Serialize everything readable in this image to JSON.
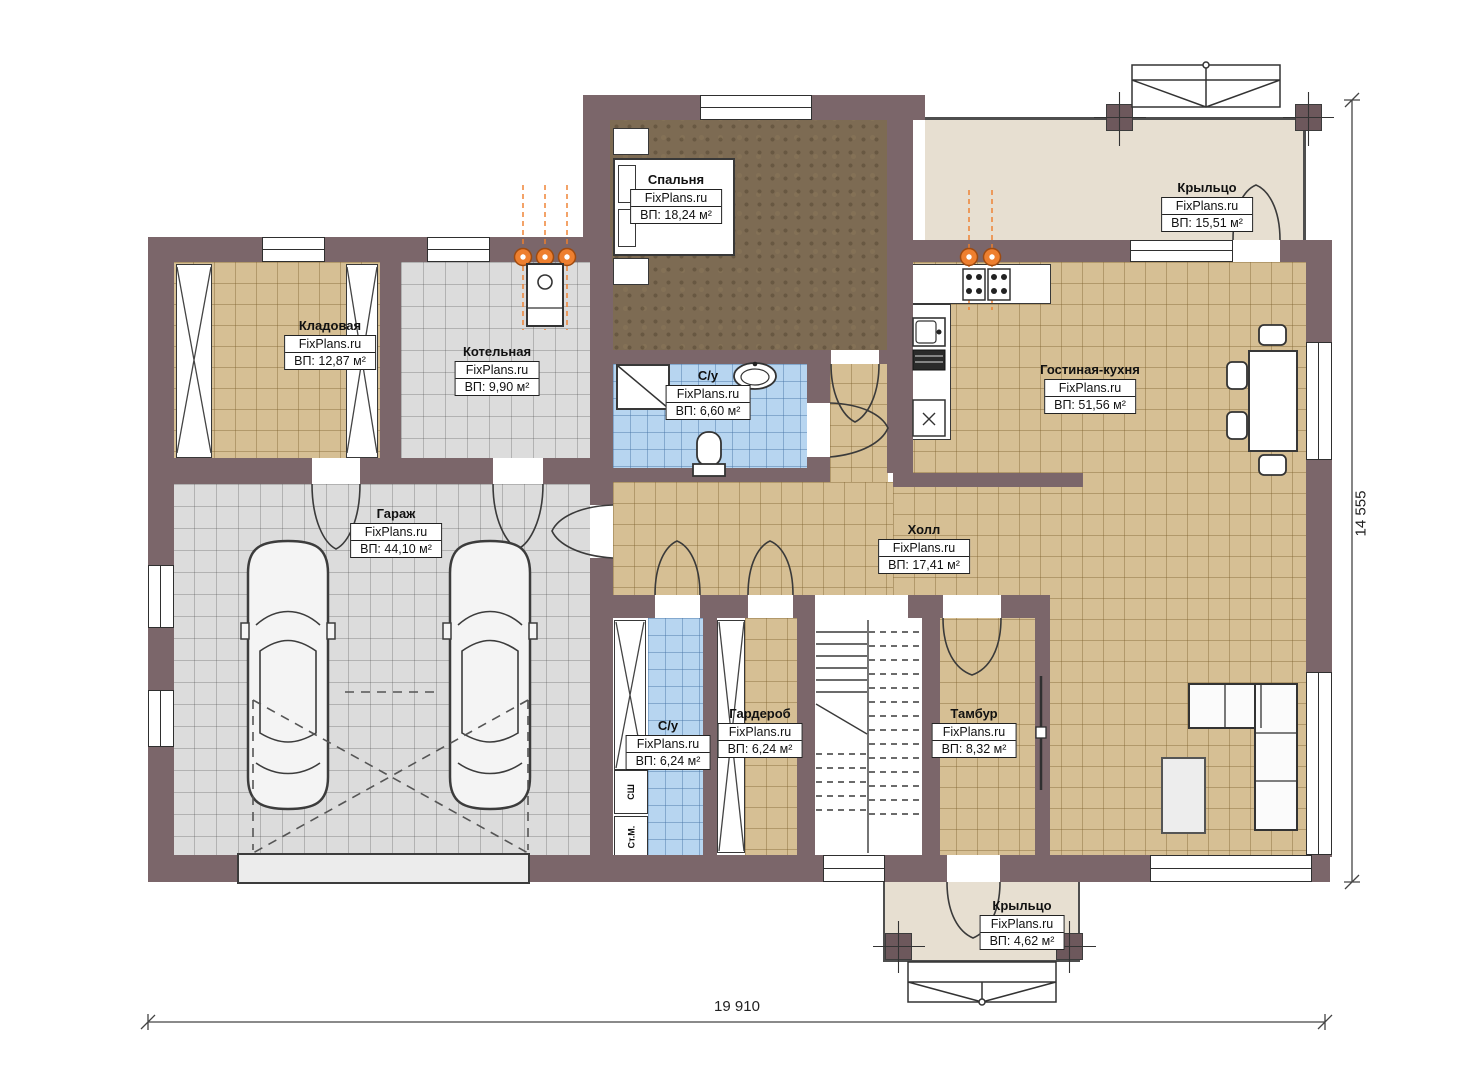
{
  "watermark": "FixPlans.ru",
  "rooms": [
    {
      "name": "Спальня",
      "area": "ВП: 18,24 м²"
    },
    {
      "name": "Кладовая",
      "area": "ВП: 12,87 м²"
    },
    {
      "name": "Котельная",
      "area": "ВП: 9,90 м²"
    },
    {
      "name": "С/у",
      "area": "ВП: 6,60 м²"
    },
    {
      "name": "Гостиная-кухня",
      "area": "ВП: 51,56 м²"
    },
    {
      "name": "Крыльцо",
      "area": "ВП: 15,51 м²"
    },
    {
      "name": "Гараж",
      "area": "ВП: 44,10 м²"
    },
    {
      "name": "Холл",
      "area": "ВП: 17,41 м²"
    },
    {
      "name": "С/у",
      "area": "ВП: 6,24 м²"
    },
    {
      "name": "Гардероб",
      "area": "ВП: 6,24 м²"
    },
    {
      "name": "Тамбур",
      "area": "ВП: 8,32 м²"
    },
    {
      "name": "Крыльцо",
      "area": "ВП: 4,62 м²"
    }
  ],
  "appliances": {
    "dryer_cabinet": "СШ",
    "washing_machine": "Ст.М."
  },
  "dimensions": {
    "overall_width": "19 910",
    "overall_height": "14 555"
  },
  "colors": {
    "wall": "#7b666a",
    "floor_beige": "#d6bf94",
    "floor_gray": "#dcdcdc",
    "floor_blue": "#b7d5f0",
    "floor_bedroom": "#7d6b53",
    "floor_porch": "#e7dfd1",
    "radiator": "#ee7f2f"
  }
}
